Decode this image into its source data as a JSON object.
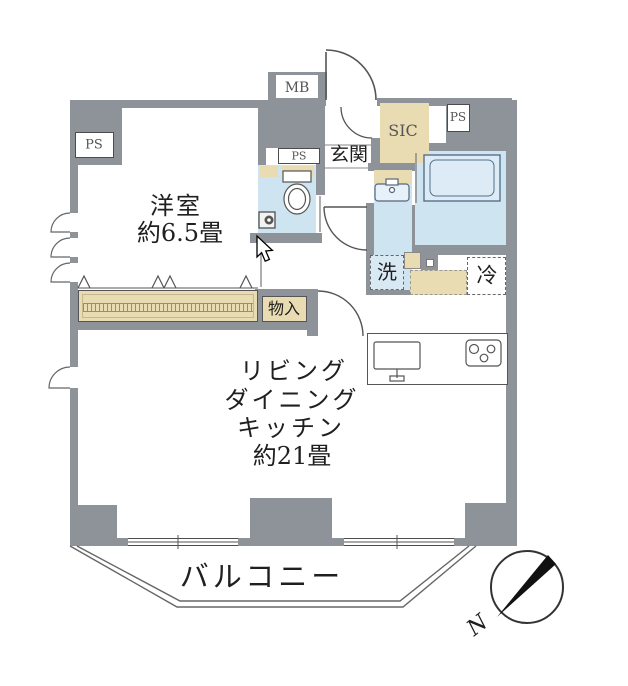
{
  "rooms": {
    "western": {
      "name": "洋室",
      "size": "約6.5畳"
    },
    "ldk": {
      "lines": [
        "リビング",
        "ダイニング",
        "キッチン",
        "約21畳"
      ]
    },
    "balcony": {
      "name": "バルコニー"
    },
    "entrance": {
      "name": "玄関"
    },
    "sic": {
      "name": "SIC"
    },
    "storage": {
      "name": "物入"
    }
  },
  "fixtures": {
    "washer": "洗",
    "fridge": "冷",
    "meter_box": "MB",
    "ps_left": "PS",
    "ps_toilet": "PS",
    "ps_right": "PS"
  },
  "compass": {
    "north": "N"
  },
  "colors": {
    "wall": "#8e939a",
    "water": "#cfe4f1",
    "wood": "#e9dcb2",
    "line": "#4c4c4c"
  }
}
